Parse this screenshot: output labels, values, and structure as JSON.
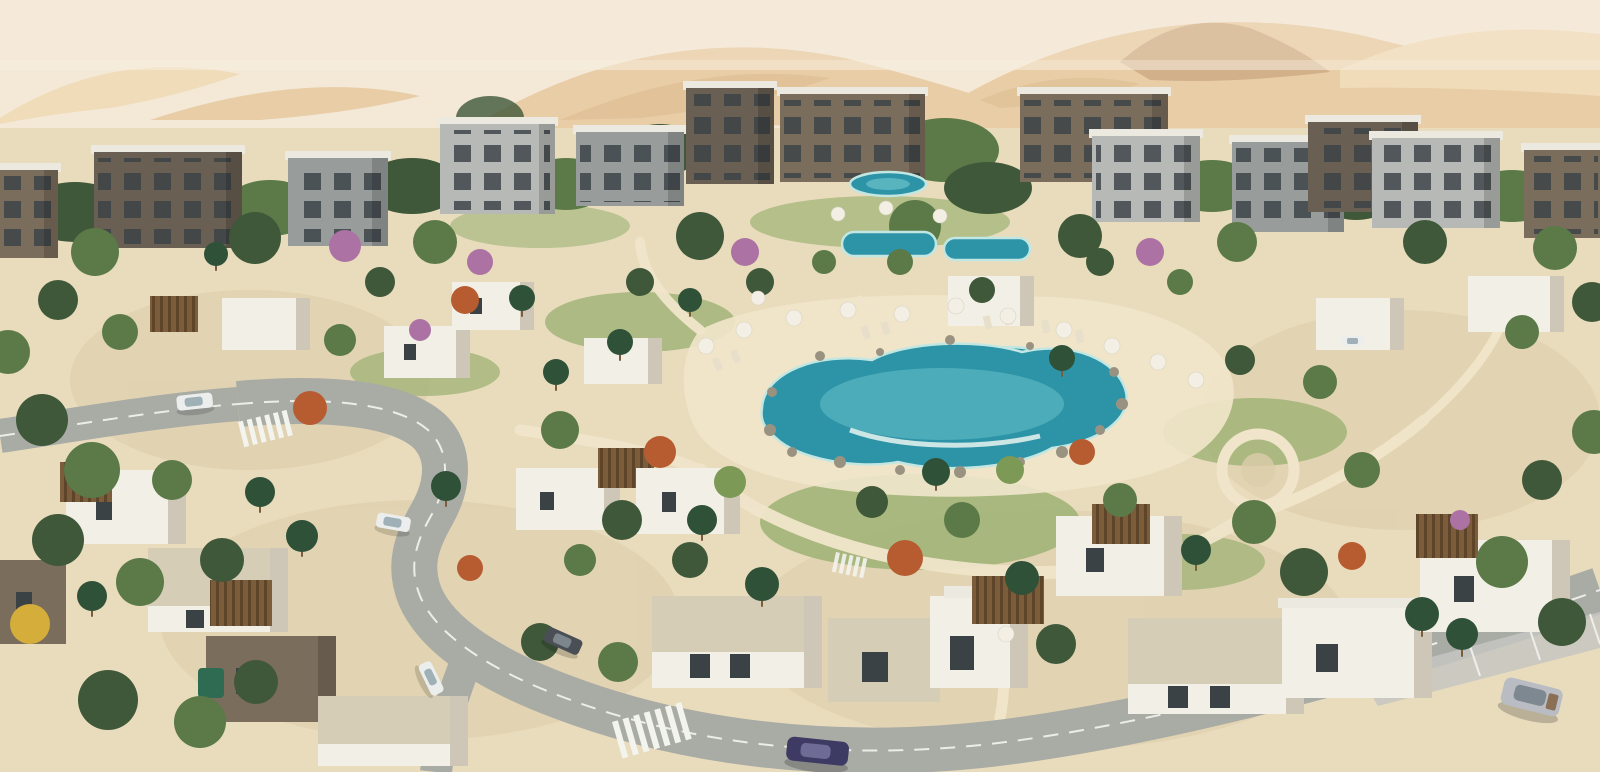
{
  "image": {
    "kind": "aerial-architectural-render",
    "description": "Aerial rendering of a desert resort community: sand dunes on the horizon, a band of three-storey apartment buildings, clusters of white and stone single-storey villas with wooden pergolas, a central free-form lagoon pool ringed by rocks, white sun umbrellas and loungers, smaller pools near the apartments, winding grey roads with white markings, crosswalks, parked and moving cars, and dense green landscaping with palms, olive-green trees, orange autumn trees and purple flowering shrubs.",
    "visible_text": "",
    "elements": [
      "desert-dunes",
      "haze-band",
      "apartment-buildings",
      "villas",
      "pergolas",
      "lagoon-pool",
      "upper-pools",
      "pool-rocks",
      "sun-umbrellas",
      "loungers",
      "sand-paths",
      "circular-plaza",
      "lawns",
      "roads",
      "crosswalks",
      "parking-bays",
      "cars",
      "palm-trees",
      "green-trees",
      "autumn-trees",
      "flowering-trees"
    ],
    "counts": {
      "cars": 7,
      "pools": 4,
      "crosswalks": 3,
      "apartment_blocks": 13
    }
  },
  "scene": {
    "palette": {
      "sky": "#f2e4d2",
      "haze": "#f8efe0",
      "dune_light": "#ecd0a2",
      "dune_mid": "#dfb884",
      "dune_deep": "#cfa066",
      "dune_rock": "#b5834d",
      "ground_sand": "#e9dcbd",
      "sand_path": "#f0e5ca",
      "gravel": "#dccdaa",
      "lawn": "#9db274",
      "tree_dark": "#3f5839",
      "tree_mid": "#5b7a48",
      "tree_light": "#7c9a55",
      "palm": "#2f5138",
      "autumn": "#b75c31",
      "bloom": "#ab72a3",
      "yellow_tree": "#d4ad3b",
      "pool_deep": "#2d93a6",
      "pool_light": "#74cbd0",
      "pool_pale": "#c2e7e3",
      "rock": "#9a9280",
      "road": "#a9aba5",
      "road_light": "#c5c6c1",
      "road_line": "#f4f4ef",
      "roof_white": "#ebe9e0",
      "wall_white": "#f2efe6",
      "wall_shadow": "#cec7b7",
      "stone": "#d6cdb7",
      "facade_dark": "#695f52",
      "facade_brown": "#7b6d5c",
      "facade_gray": "#989c9a",
      "facade_light": "#b6b9b5",
      "window": "#3b4245",
      "wood": "#7b5d3c",
      "umbrella": "#f3efe5",
      "lounger": "#e7dfca",
      "car_white": "#eceeee",
      "car_dark": "#4a4e55",
      "car_blue": "#3d3a63",
      "car_silver": "#b9bdc3"
    }
  }
}
